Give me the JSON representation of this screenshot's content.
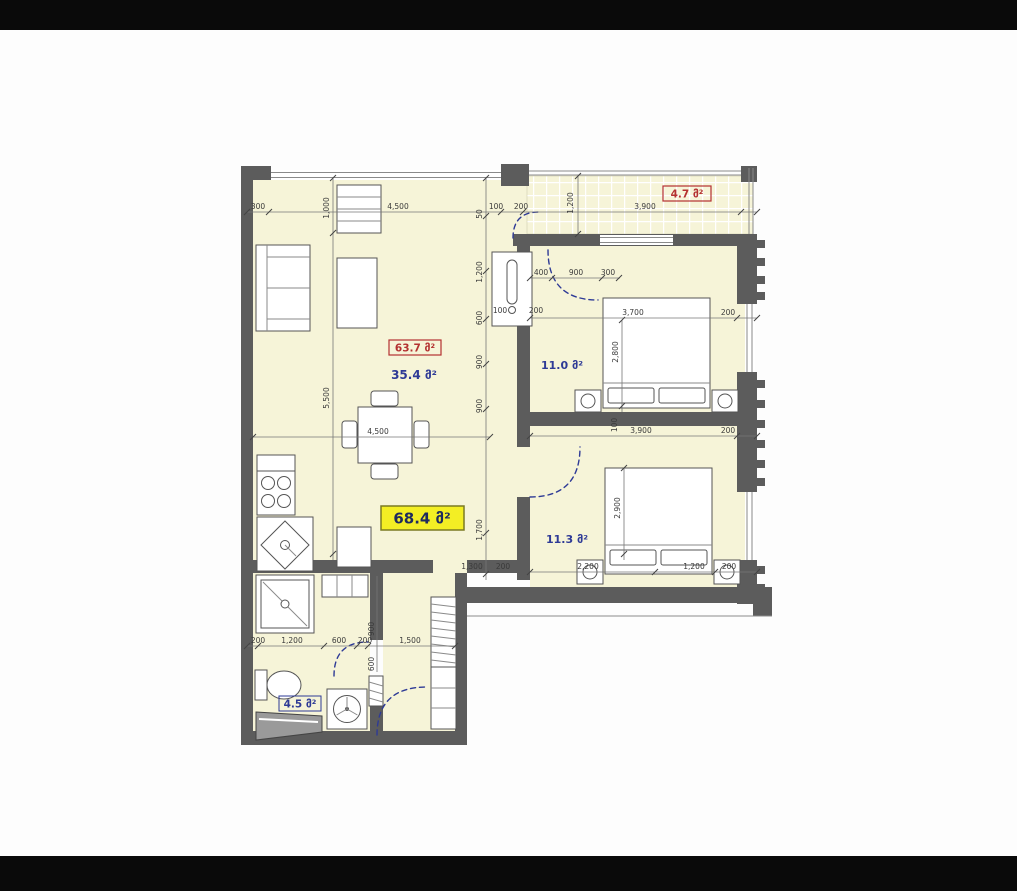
{
  "plan": {
    "title_hint": "apartment floor plan",
    "areas": {
      "total_red": "63.7 მ²",
      "living": "35.4 მ²",
      "balcony": "4.7 მ²",
      "bedroom1": "11.0 მ²",
      "bedroom2": "11.3 მ²",
      "bathroom": "4.5 მ²",
      "total_yellow": "68.4 მ²"
    },
    "dims": {
      "top": [
        "300",
        "4,500",
        "100",
        "200",
        "3,900"
      ],
      "balcony_depth": "1,200",
      "shelf_height": "1,000",
      "living_height": "5,500",
      "living_width": "4,500",
      "corridor": [
        "50",
        "1,200",
        "600",
        "900",
        "900",
        "1,700"
      ],
      "corridor_marks": [
        "100",
        "200",
        "1,300",
        "200"
      ],
      "bedroom1_door": [
        "400",
        "900",
        "300"
      ],
      "bedroom1_width": [
        "3,700",
        "200"
      ],
      "bedroom1_depth": "2,800",
      "between": [
        "3,900",
        "200",
        "100"
      ],
      "bedroom2_depth": "2,900",
      "bedroom2_bottom": [
        "2,200",
        "1,200",
        "200"
      ],
      "bathroom_bottom": [
        "200",
        "1,200",
        "600",
        "200",
        "1,500"
      ],
      "bathroom_side": [
        "900",
        "600"
      ]
    },
    "colors": {
      "floor": "#f6f4d8",
      "wall": "#5c5c5c",
      "accent_blue": "#2e3a96",
      "accent_red": "#b43131",
      "highlight_yellow": "#f3ee24",
      "letterbox": "#0a0a0a"
    }
  }
}
